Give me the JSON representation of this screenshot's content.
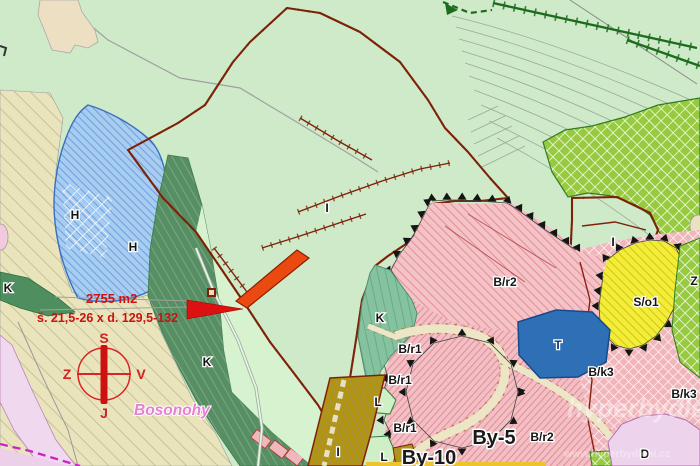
{
  "map": {
    "region_name": "Bosonohy",
    "highlight": {
      "area_label": "2755 m2",
      "plot_dimensions_label": "š. 21,5-26 x d. 129,5-132"
    },
    "compass": {
      "north_label": "S",
      "east_label": "V",
      "south_label": "J",
      "west_label": "Z"
    },
    "zone_labels": [
      {
        "text": "H",
        "x": 75,
        "y": 219
      },
      {
        "text": "H",
        "x": 133,
        "y": 251
      },
      {
        "text": "K",
        "x": 8,
        "y": 292
      },
      {
        "text": "K",
        "x": 207,
        "y": 366
      },
      {
        "text": "K",
        "x": 380,
        "y": 322
      },
      {
        "text": "I",
        "x": 327,
        "y": 212
      },
      {
        "text": "I",
        "x": 613,
        "y": 246
      },
      {
        "text": "I",
        "x": 338,
        "y": 456
      },
      {
        "text": "L",
        "x": 378,
        "y": 406
      },
      {
        "text": "L",
        "x": 384,
        "y": 461
      },
      {
        "text": "B/r1",
        "x": 410,
        "y": 353
      },
      {
        "text": "B/r1",
        "x": 400,
        "y": 384
      },
      {
        "text": "B/r1",
        "x": 405,
        "y": 432
      },
      {
        "text": "B/r2",
        "x": 505,
        "y": 286
      },
      {
        "text": "B/r2",
        "x": 542,
        "y": 441
      },
      {
        "text": "B/k3",
        "x": 601,
        "y": 376
      },
      {
        "text": "B/k3",
        "x": 684,
        "y": 398
      },
      {
        "text": "S/o1",
        "x": 646,
        "y": 306
      },
      {
        "text": "Z",
        "x": 694,
        "y": 285
      },
      {
        "text": "T",
        "x": 558,
        "y": 349,
        "color": "#14356e"
      },
      {
        "text": "D",
        "x": 645,
        "y": 458
      }
    ],
    "district_labels": [
      {
        "text": "By-5",
        "x": 494,
        "y": 444
      },
      {
        "text": "By-10",
        "x": 429,
        "y": 464
      }
    ],
    "watermark": {
      "brand": "hyperbydlení",
      "url": "www.hyperbydleni.cz"
    },
    "colors": {
      "highlight_parcel": "#ea4a10",
      "annotation_red": "#cc1111",
      "water_blue": "#2e6fb6",
      "olive_zone": "#b29410",
      "pink_zone": "#f4c3c7",
      "yellow_zone": "#f3ed3a",
      "green_hatch": "#97ca40"
    }
  }
}
